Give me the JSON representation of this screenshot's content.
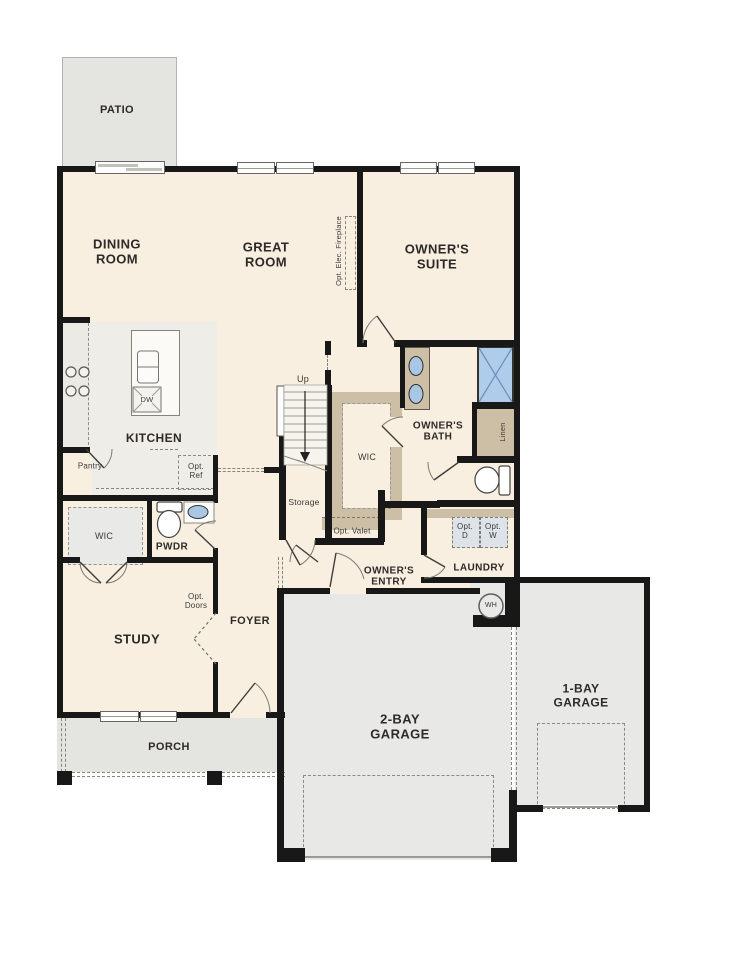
{
  "plan": {
    "title": "single-story floor plan",
    "labels": {
      "patio": "PATIO",
      "dining": [
        "DINING",
        "ROOM"
      ],
      "great": [
        "GREAT",
        "ROOM"
      ],
      "suite": [
        "OWNER'S",
        "SUITE"
      ],
      "fireplace": "Opt. Elec. Fireplace",
      "kitchen": "KITCHEN",
      "dw": "DW",
      "pantry": "Pantry",
      "opt_ref": [
        "Opt.",
        "Ref"
      ],
      "up": "Up",
      "storage": "Storage",
      "wic_main": "WIC",
      "owners_bath": [
        "OWNER'S",
        "BATH"
      ],
      "linen": "Linen",
      "opt_valet": "Opt. Valet",
      "opt_d": [
        "Opt.",
        "D"
      ],
      "opt_w": [
        "Opt.",
        "W"
      ],
      "laundry": "LAUNDRY",
      "owners_entry": [
        "OWNER'S",
        "ENTRY"
      ],
      "pwdr": "PWDR",
      "wic_study": "WIC",
      "study": "STUDY",
      "opt_doors": [
        "Opt.",
        "Doors"
      ],
      "foyer": "FOYER",
      "porch": "PORCH",
      "garage2": [
        "2-BAY",
        "GARAGE"
      ],
      "garage1": [
        "1-BAY",
        "GARAGE"
      ],
      "wh": "WH"
    },
    "colors": {
      "wall": "#181818",
      "room_fill": "#f8efe1",
      "kitchen_floor": "#efede8",
      "outdoor_fill": "#e4e4e1",
      "garage_fill": "#e8e8e6",
      "closet_tan": "#cdbfa5",
      "fixture_blue": "#a9c7e4",
      "shower_blue": "#afccea",
      "appliance_box": "#dde3e8",
      "text": "#2d2a27"
    }
  }
}
